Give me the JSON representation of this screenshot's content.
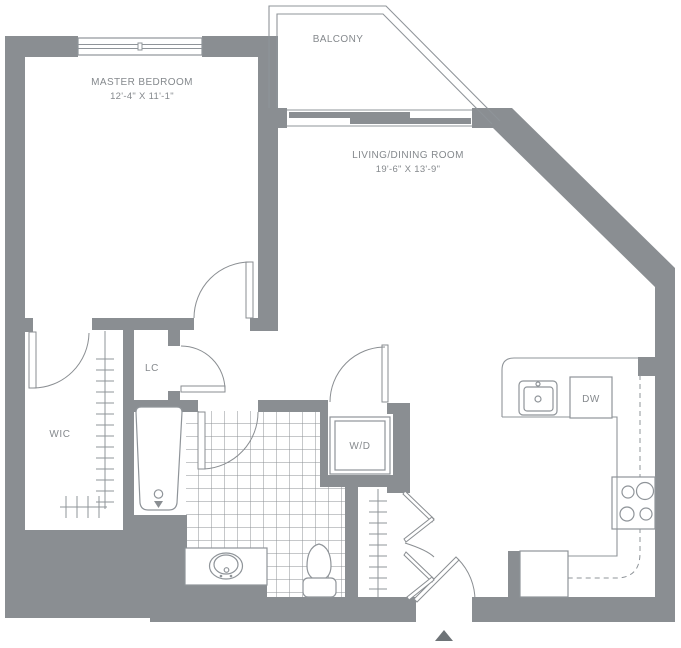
{
  "plan": {
    "title": "apartment-floor-plan",
    "rooms": {
      "master_bedroom": {
        "label": "MASTER BEDROOM",
        "dims": "12'-4\" X 11'-1\""
      },
      "balcony": {
        "label": "BALCONY"
      },
      "living_dining": {
        "label": "LIVING/DINING ROOM",
        "dims": "19'-6\" X 13'-9\""
      },
      "wic": {
        "label": "WIC"
      },
      "lc": {
        "label": "LC"
      }
    },
    "appliances": {
      "washer_dryer": {
        "label": "W/D"
      },
      "dishwasher": {
        "label": "DW"
      }
    },
    "icons": [
      "entry-arrow-icon",
      "window-icon",
      "sliding-door-icon",
      "door-swing-icon",
      "bifold-door-icon",
      "closet-rod-icon",
      "bathtub-icon",
      "toilet-icon",
      "vanity-sink-icon",
      "kitchen-sink-icon",
      "stove-burners-icon"
    ],
    "colors": {
      "wall": "#8a8e92",
      "line": "#8f9499",
      "text": "#85898d",
      "arrow": "#6e7377",
      "background": "#ffffff"
    }
  }
}
